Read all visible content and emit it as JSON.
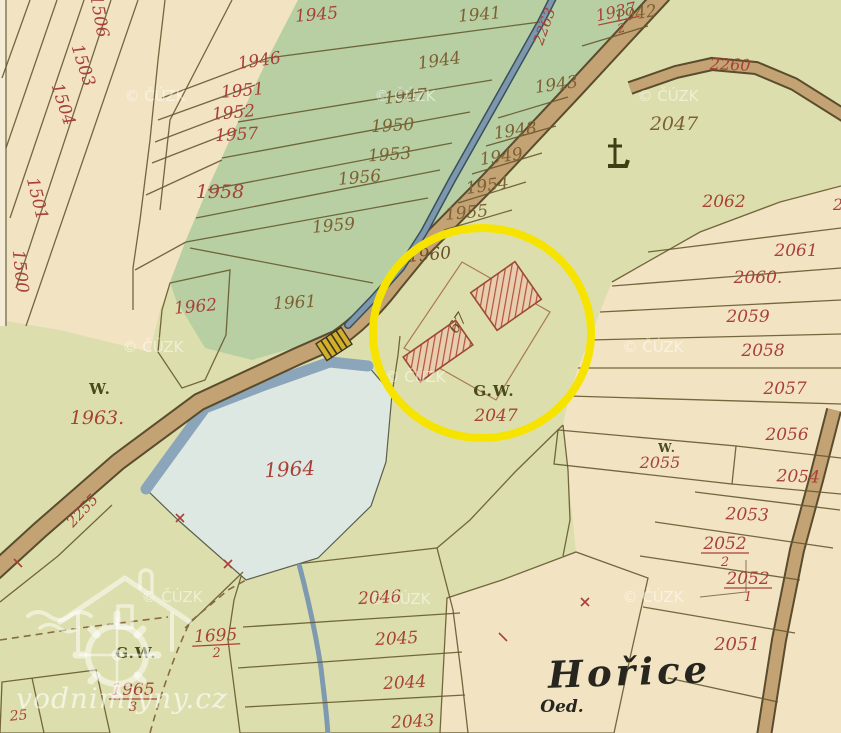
{
  "palette": {
    "paper_cream": "#f2e3c3",
    "field_green": "#b7cfa2",
    "meadow_olive": "#dcdfad",
    "pond_fill": "#dee8e3",
    "water_blue": "#8ba5ba",
    "road_tan": "#c3a273",
    "highlight_yellow": "#f6e400",
    "label_red": "#a84138",
    "label_brown": "#7d6133",
    "building_hatch_red": "#b0543c",
    "bridge_yellow": "#d2af2a",
    "parcel_yellow": "#e0bd4e"
  },
  "watermarks": {
    "copyright": "© ČÚZK",
    "site": "vodnimlyny.cz"
  },
  "annotation": {
    "shape": "circle",
    "color": "#f6e400"
  },
  "place_labels": {
    "horice": "Hořice",
    "oed": "Oed."
  },
  "road_labels": {
    "r2255": "2255",
    "r2260": "2260",
    "r2263": "2263"
  },
  "symbol_labels": {
    "w_1963": "W.",
    "w_2055": "W.",
    "gw_circle": "G.W.",
    "gw_mill": "G.W.",
    "house_67": "67"
  },
  "parcel_labels": {
    "n1500": "1500",
    "n1501": "1501",
    "n1503": "1503",
    "n1504": "1504",
    "n1506": "1506",
    "n1941": "1941",
    "n1942": "1942",
    "n1943": "1943",
    "n1944": "1944",
    "n1945": "1945",
    "n1946": "1946",
    "n1947": "1947",
    "n1948": "1948",
    "n1949": "1949",
    "n1950": "1950",
    "n1951": "1951",
    "n1952": "1952",
    "n1953": "1953",
    "n1954": "1954",
    "n1955": "1955",
    "n1956": "1956",
    "n1957": "1957",
    "n1958": "1958",
    "n1959": "1959",
    "n1960": "1960",
    "n1961": "1961",
    "n1962": "1962",
    "n1963": "1963.",
    "n1964": "1964",
    "n2043": "2043",
    "n2044": "2044",
    "n2045": "2045",
    "n2046": "2046",
    "n2047_top": "2047",
    "n2047_circle": "2047",
    "n2051": "2051",
    "n2053": "2053",
    "n2054": "2054",
    "n2055": "2055",
    "n2056": "2056",
    "n2057": "2057",
    "n2058": "2058",
    "n2059": "2059",
    "n2060": "2060.",
    "n2061": "2061",
    "n2062": "2062",
    "n25": "25",
    "n_edge_partial": "2"
  },
  "fractions": {
    "f1937": {
      "num": "1937",
      "den": "2"
    },
    "f1695": {
      "num": "1695",
      "den": "2"
    },
    "f1965": {
      "num": "1965",
      "den": "3"
    },
    "f2052a": {
      "num": "2052",
      "den": "2"
    },
    "f2052b": {
      "num": "2052",
      "den": "1"
    }
  }
}
